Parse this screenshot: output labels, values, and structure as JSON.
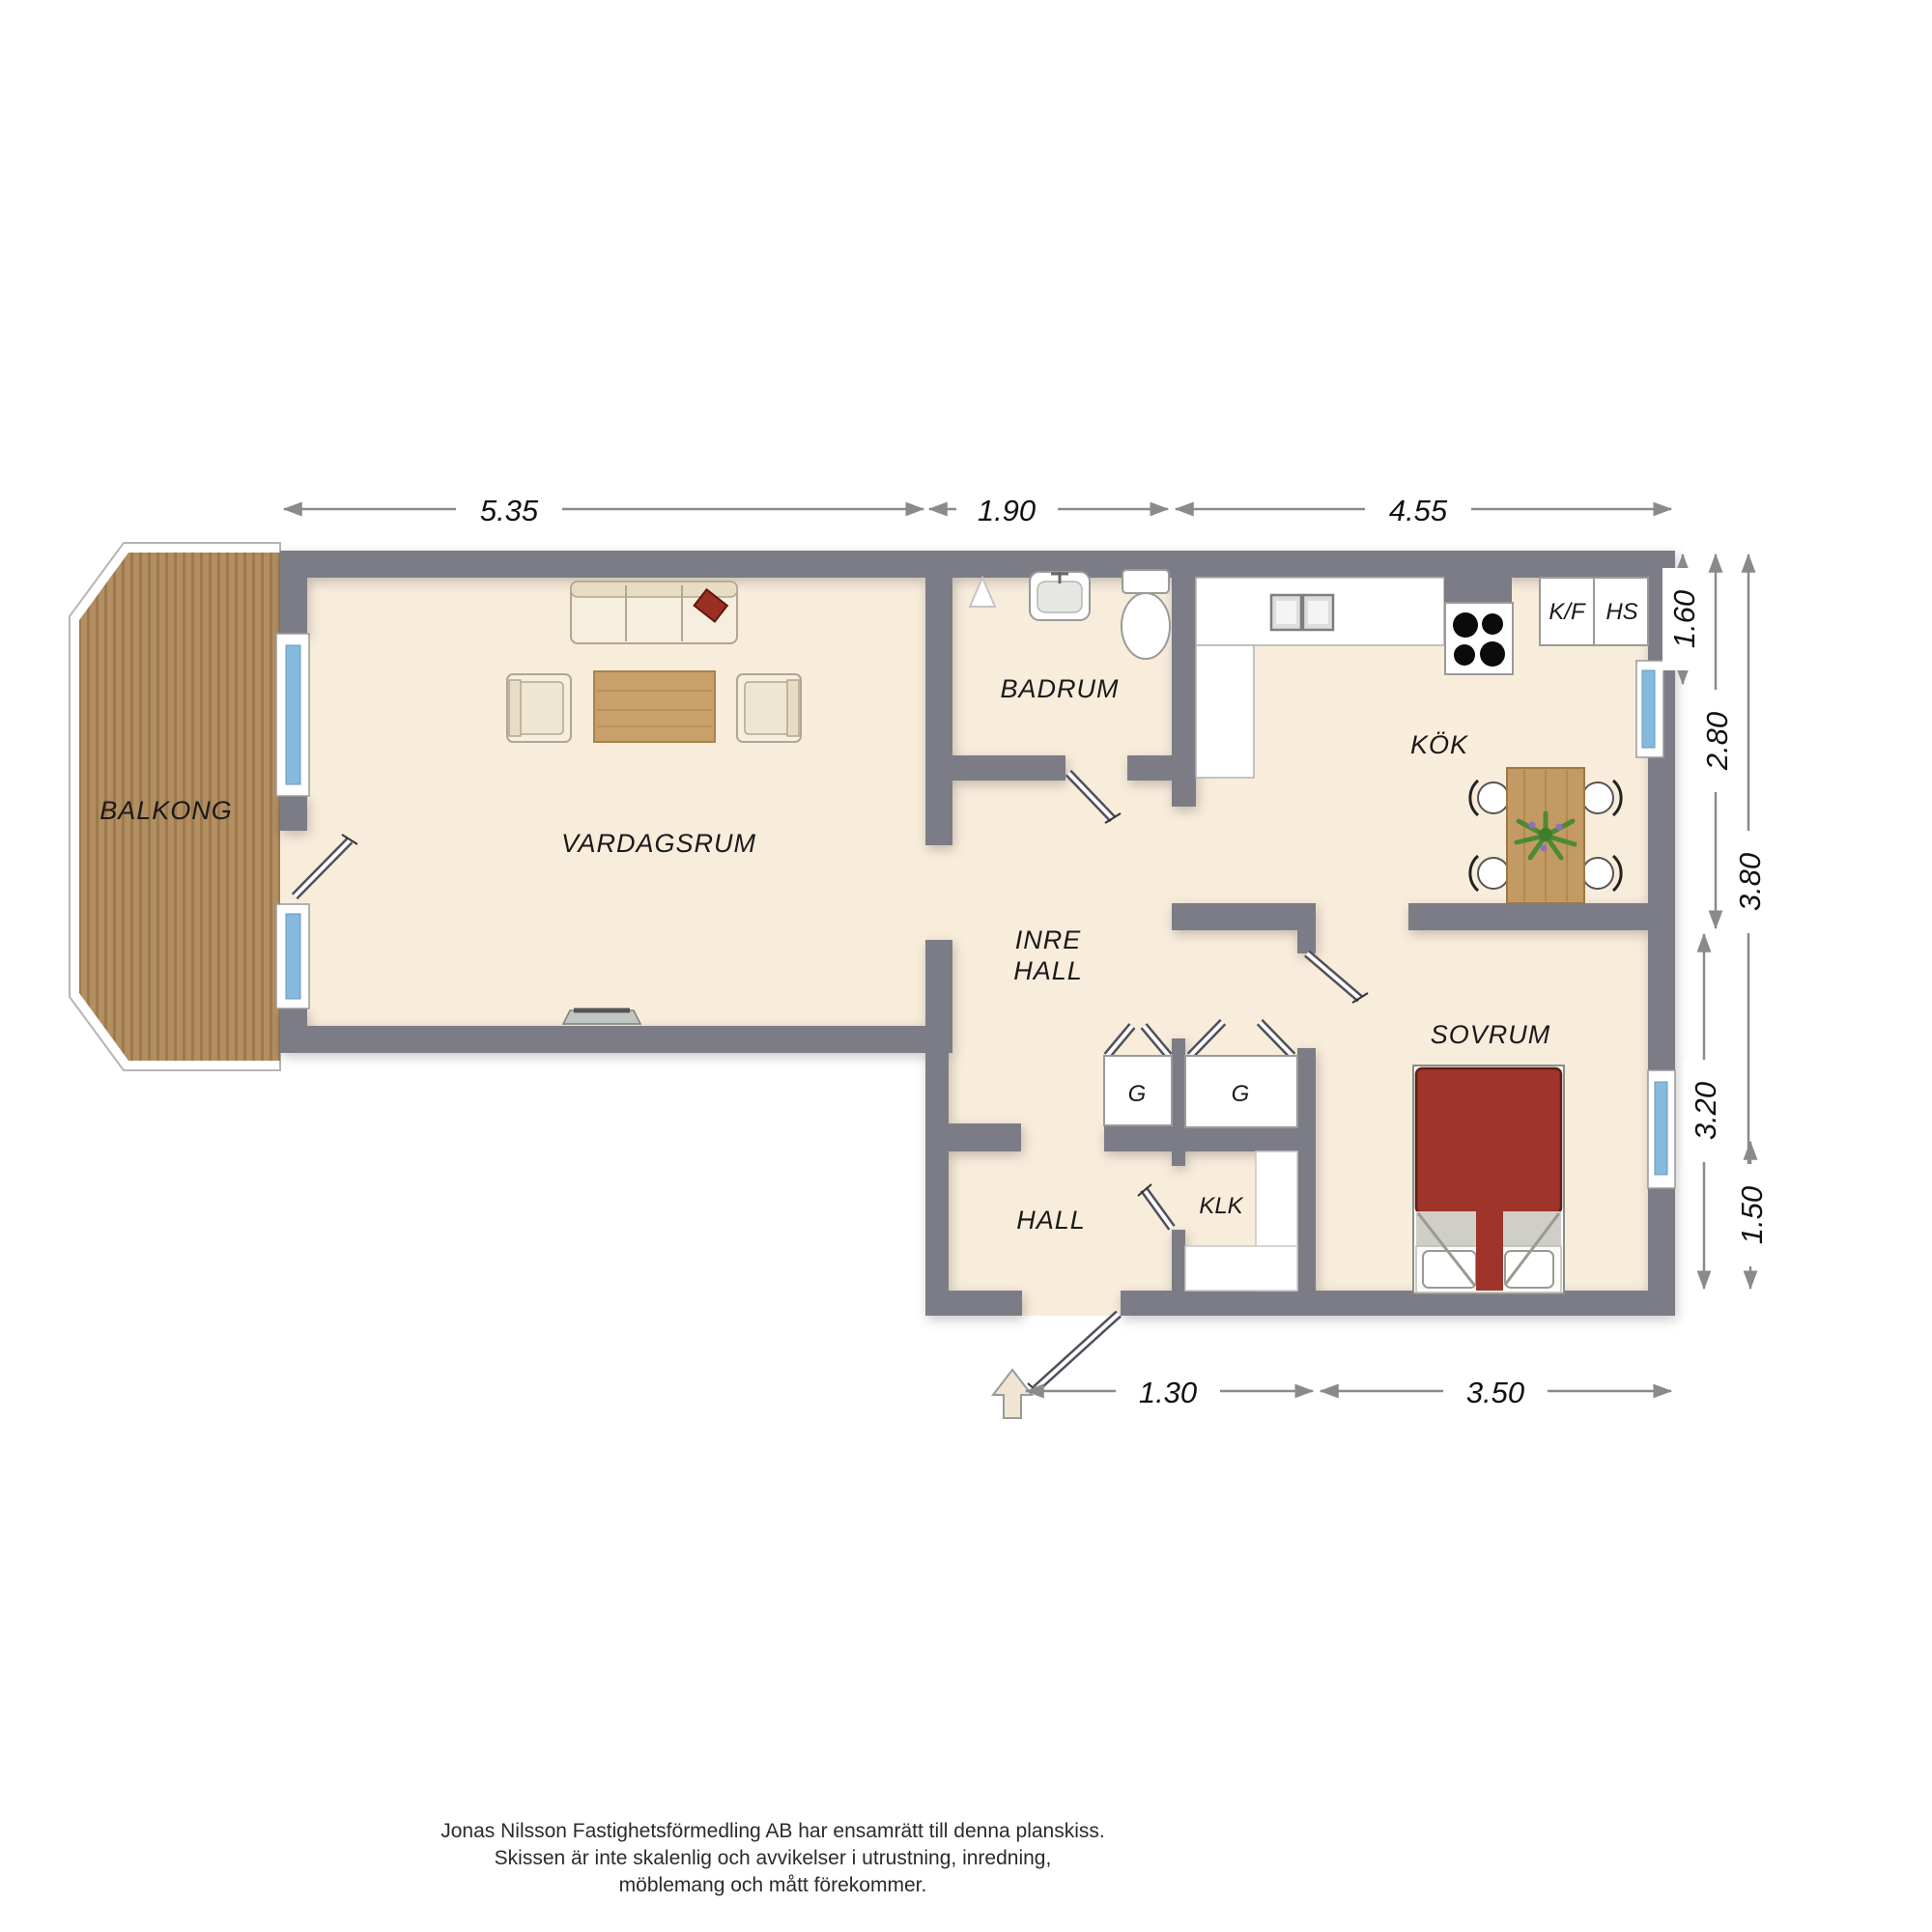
{
  "rooms": {
    "balkong": "BALKONG",
    "vardagsrum": "VARDAGSRUM",
    "badrum": "BADRUM",
    "kok": "KÖK",
    "inre_hall_line1": "INRE",
    "inre_hall_line2": "HALL",
    "hall": "HALL",
    "klk": "KLK",
    "sovrum": "SOVRUM"
  },
  "closets": {
    "g_left": "G",
    "g_right": "G"
  },
  "kitchen_units": {
    "fridge_freezer": "K/F",
    "hs": "HS"
  },
  "dimensions": {
    "top": [
      "5.35",
      "1.90",
      "4.55"
    ],
    "right": [
      "1.60",
      "2.80",
      "3.80",
      "3.20",
      "1.50"
    ],
    "bottom": [
      "1.30",
      "3.50"
    ]
  },
  "footer": {
    "line1": "Jonas Nilsson Fastighetsförmedling AB har ensamrätt till denna planskiss.",
    "line2": "Skissen är inte skalenlig och avvikelser i utrustning, inredning,",
    "line3": "möblemang och mått förekommer."
  },
  "colors": {
    "wall": "#7c7c86",
    "floor": "#f8ecdb",
    "balcony_wood": "#b28e61",
    "window_glass": "#85bade",
    "bed": "#9e342a",
    "table_wood": "#c49a64",
    "dimension_line": "#8a8a8a"
  }
}
